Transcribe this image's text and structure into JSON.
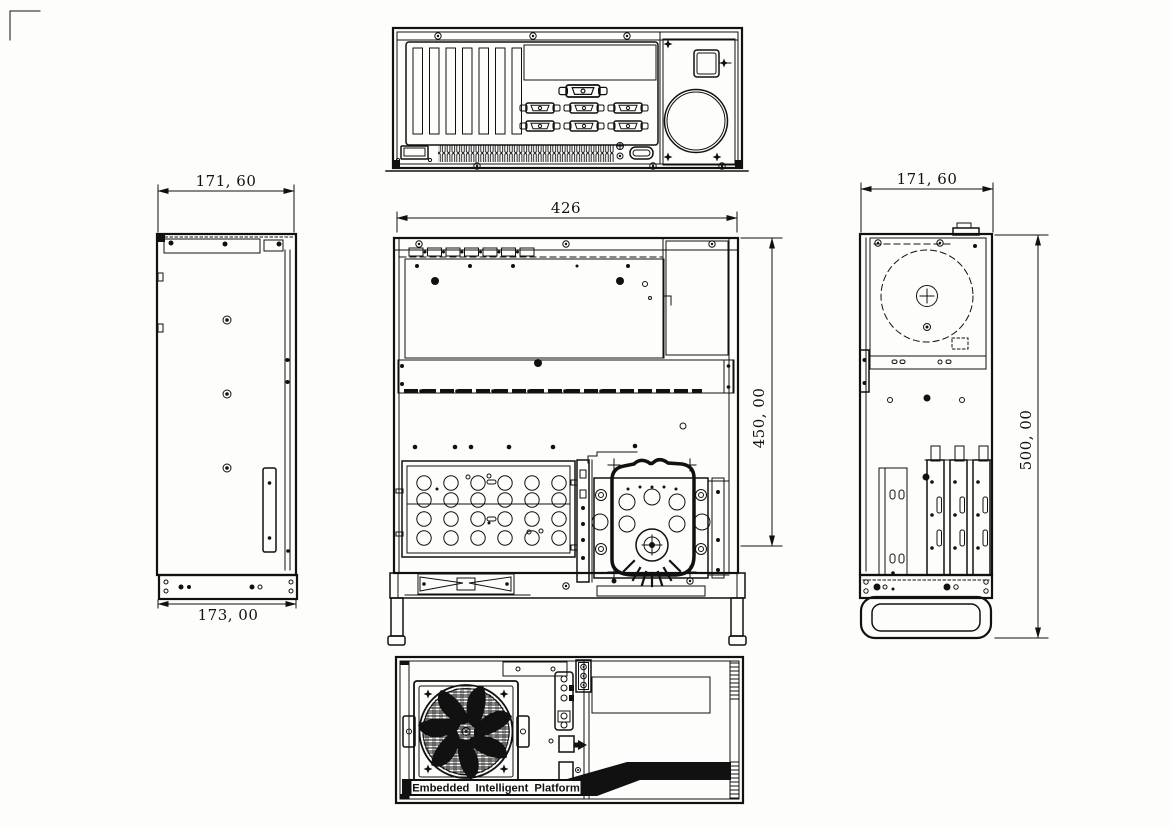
{
  "dimensions": {
    "left_view_width": "171, 60",
    "left_view_bottom_width": "173, 00",
    "top_view_width": "426",
    "top_view_height": "450, 00",
    "right_view_width": "171, 60",
    "right_view_height": "500, 00"
  },
  "front_panel": {
    "brand_label": "Embedded Intelligent Platform"
  },
  "colors": {
    "ink": "#111111",
    "paper": "#fdfdfb"
  }
}
